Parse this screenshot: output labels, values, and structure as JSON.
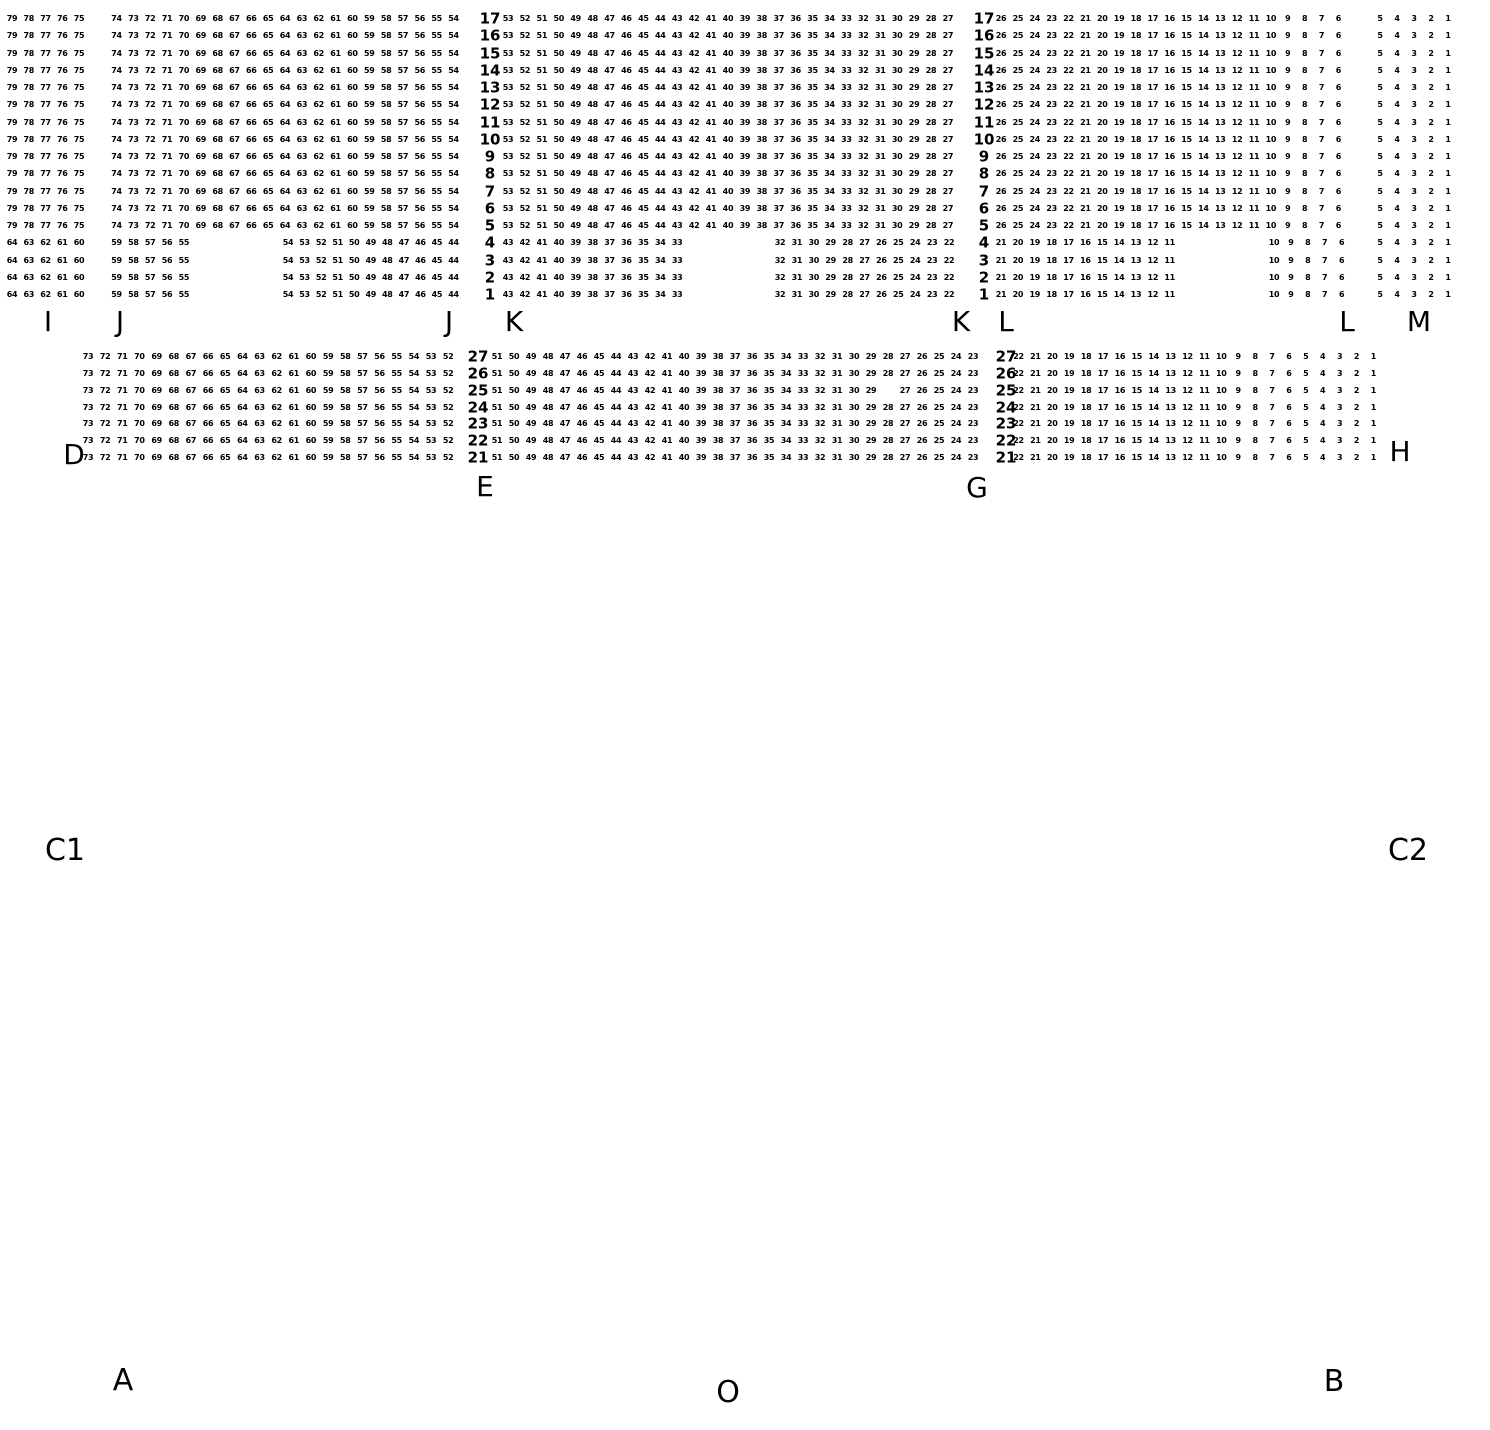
{
  "canvas": {
    "background": "#ffffff",
    "ink": "#000000"
  },
  "seat_map": {
    "blocks": [
      {
        "name": "upper-full-rows",
        "rows": [
          17,
          16,
          15,
          14,
          13,
          12,
          11,
          10,
          9,
          8,
          7,
          6,
          5
        ],
        "y_first": 19,
        "y_step": 17.25,
        "segments": [
          {
            "kind": "seats",
            "section": "I",
            "from": 79,
            "to": 75,
            "x": 12,
            "step": 16.75
          },
          {
            "kind": "seats",
            "section": "J",
            "from": 74,
            "to": 54,
            "x": 116.5,
            "step": 16.85
          },
          {
            "kind": "rownum",
            "x": 490
          },
          {
            "kind": "seats",
            "section": "K",
            "from": 53,
            "to": 27,
            "x": 508,
            "step": 16.92
          },
          {
            "kind": "rownum",
            "x": 984
          },
          {
            "kind": "seats",
            "section": "L",
            "from": 26,
            "to": 6,
            "x": 1001,
            "step": 16.87
          },
          {
            "kind": "seats",
            "section": "M",
            "from": 5,
            "to": 1,
            "x": 1380,
            "step": 17
          }
        ]
      },
      {
        "name": "upper-short-rows",
        "rows": [
          4,
          3,
          2,
          1
        ],
        "y_first": 243.25,
        "y_step": 17.25,
        "segments": [
          {
            "kind": "seats",
            "section": "I",
            "from": 64,
            "to": 60,
            "x": 12,
            "step": 16.75
          },
          {
            "kind": "seats",
            "section": "J",
            "from": 59,
            "to": 55,
            "x": 116.5,
            "step": 16.85
          },
          {
            "kind": "seats",
            "section": "J",
            "from": 54,
            "to": 44,
            "x": 288,
            "step": 16.55
          },
          {
            "kind": "rownum",
            "x": 490
          },
          {
            "kind": "seats",
            "section": "K",
            "from": 43,
            "to": 33,
            "x": 508,
            "step": 16.92
          },
          {
            "kind": "seats",
            "section": "K",
            "from": 32,
            "to": 22,
            "x": 780,
            "step": 16.9
          },
          {
            "kind": "rownum",
            "x": 984
          },
          {
            "kind": "seats",
            "section": "L",
            "from": 21,
            "to": 11,
            "x": 1001,
            "step": 16.87
          },
          {
            "kind": "seats",
            "section": "L",
            "from": 10,
            "to": 6,
            "x": 1274,
            "step": 16.9
          },
          {
            "kind": "seats",
            "section": "M",
            "from": 5,
            "to": 1,
            "x": 1380,
            "step": 17
          }
        ]
      },
      {
        "name": "lower-rows",
        "rows": [
          27,
          26,
          25,
          24,
          23,
          22,
          21
        ],
        "y_first": 357,
        "y_step": 16.85,
        "omissions": [
          {
            "row": 25,
            "seat": 28
          }
        ],
        "segments": [
          {
            "kind": "seats",
            "section": "left",
            "from": 73,
            "to": 52,
            "x": 88,
            "step": 17.15
          },
          {
            "kind": "rownum",
            "x": 478
          },
          {
            "kind": "seats",
            "section": "middle",
            "from": 51,
            "to": 23,
            "x": 497,
            "step": 17.0
          },
          {
            "kind": "rownum",
            "x": 1006
          },
          {
            "kind": "seats",
            "section": "right",
            "from": 22,
            "to": 1,
            "x": 1018.5,
            "step": 16.9
          }
        ]
      }
    ],
    "entrance_labels": [
      {
        "text": "I",
        "x": 48,
        "y": 322,
        "size": 28
      },
      {
        "text": "J",
        "x": 120,
        "y": 322,
        "size": 28
      },
      {
        "text": "J",
        "x": 449,
        "y": 322,
        "size": 28
      },
      {
        "text": "K",
        "x": 514,
        "y": 322,
        "size": 28
      },
      {
        "text": "K",
        "x": 961,
        "y": 322,
        "size": 28
      },
      {
        "text": "L",
        "x": 1006,
        "y": 322,
        "size": 28
      },
      {
        "text": "L",
        "x": 1347,
        "y": 322,
        "size": 28
      },
      {
        "text": "M",
        "x": 1419,
        "y": 322,
        "size": 28
      },
      {
        "text": "D",
        "x": 74,
        "y": 455,
        "size": 28
      },
      {
        "text": "H",
        "x": 1400,
        "y": 452,
        "size": 28
      },
      {
        "text": "E",
        "x": 485,
        "y": 487,
        "size": 28
      },
      {
        "text": "G",
        "x": 977,
        "y": 488,
        "size": 28
      },
      {
        "text": "C1",
        "x": 65,
        "y": 851,
        "size": 30
      },
      {
        "text": "C2",
        "x": 1408,
        "y": 851,
        "size": 30
      },
      {
        "text": "A",
        "x": 123,
        "y": 1381,
        "size": 30
      },
      {
        "text": "B",
        "x": 1334,
        "y": 1382,
        "size": 30
      },
      {
        "text": "O",
        "x": 728,
        "y": 1393,
        "size": 30
      }
    ]
  }
}
